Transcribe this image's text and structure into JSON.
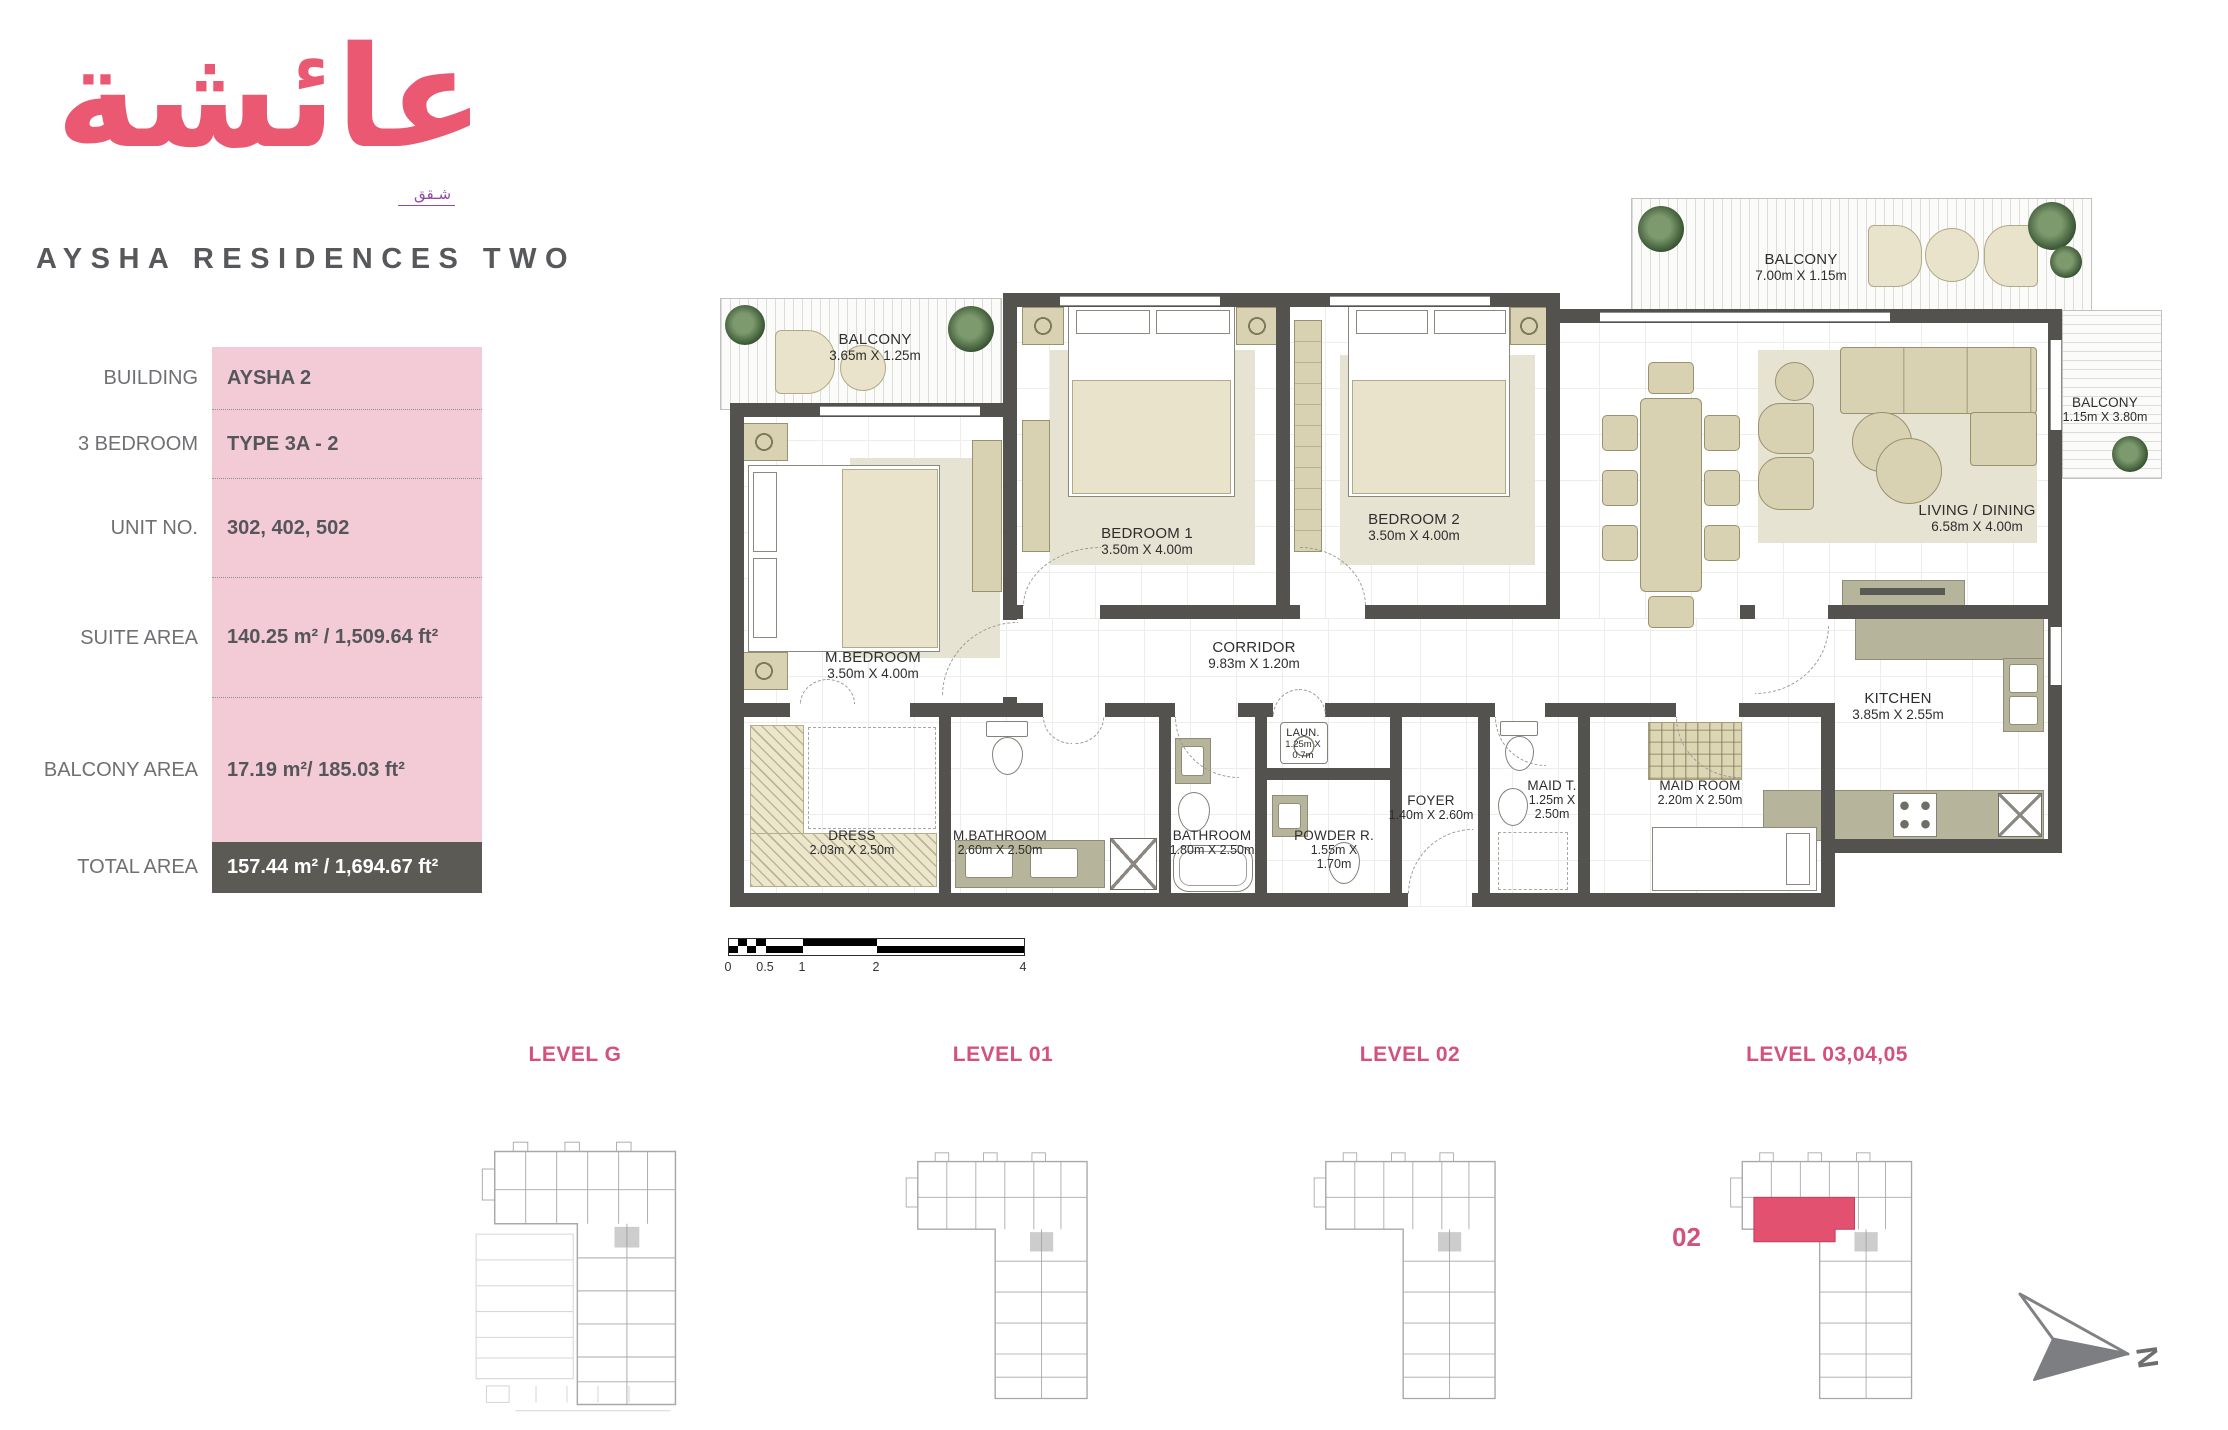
{
  "logo": {
    "arabic": "عائشة",
    "arabic_subtitle": "شـقق",
    "brand": "AYSHA RESIDENCES TWO"
  },
  "info_panel": {
    "rows": [
      {
        "label": "BUILDING",
        "value": "AYSHA 2"
      },
      {
        "label": "3 BEDROOM",
        "value": "TYPE 3A - 2"
      },
      {
        "label": "UNIT NO.",
        "value": "302, 402, 502"
      },
      {
        "label": "SUITE AREA",
        "value": "140.25 m² / 1,509.64 ft²"
      },
      {
        "label": "BALCONY AREA",
        "value": "17.19 m²/ 185.03 ft²"
      }
    ],
    "total_row": {
      "label": "TOTAL AREA",
      "value": "157.44 m² / 1,694.67 ft²"
    }
  },
  "floor_plan": {
    "rooms": {
      "balcony_tl": {
        "name": "BALCONY",
        "dims": "3.65m X 1.25m"
      },
      "balcony_top": {
        "name": "BALCONY",
        "dims": "7.00m X 1.15m"
      },
      "balcony_side": {
        "name": "BALCONY",
        "dims": "1.15m X 3.80m"
      },
      "m_bedroom": {
        "name": "M.BEDROOM",
        "dims": "3.50m X 4.00m"
      },
      "bedroom1": {
        "name": "BEDROOM 1",
        "dims": "3.50m X 4.00m"
      },
      "bedroom2": {
        "name": "BEDROOM 2",
        "dims": "3.50m X 4.00m"
      },
      "living": {
        "name": "LIVING / DINING",
        "dims": "6.58m X 4.00m"
      },
      "kitchen": {
        "name": "KITCHEN",
        "dims": "3.85m X 2.55m"
      },
      "corridor": {
        "name": "CORRIDOR",
        "dims": "9.83m X 1.20m"
      },
      "dress": {
        "name": "DRESS",
        "dims": "2.03m X 2.50m"
      },
      "m_bathroom": {
        "name": "M.BATHROOM",
        "dims": "2.60m X 2.50m"
      },
      "bathroom": {
        "name": "BATHROOM",
        "dims": "1.80m X 2.50m"
      },
      "powder": {
        "name": "POWDER R.",
        "dims": "1.55m X",
        "dims2": "1.70m"
      },
      "laundry": {
        "name": "LAUN.",
        "dims": "1.25m X",
        "dims2": "0.7m"
      },
      "foyer": {
        "name": "FOYER",
        "dims": "1.40m X 2.60m"
      },
      "maid_t": {
        "name": "MAID T.",
        "dims": "1.25m X",
        "dims2": "2.50m"
      },
      "maid_room": {
        "name": "MAID ROOM",
        "dims": "2.20m X 2.50m"
      }
    },
    "scale_bar": {
      "labels": [
        "0",
        "0.5",
        "1",
        "2",
        "4"
      ]
    }
  },
  "levels": [
    {
      "label": "LEVEL G"
    },
    {
      "label": "LEVEL 01"
    },
    {
      "label": "LEVEL 02"
    },
    {
      "label": "LEVEL 03,04,05",
      "highlighted_unit": "02"
    }
  ],
  "compass": {
    "north_label": "N"
  },
  "colors": {
    "accent_pink": "#ea5871",
    "level_pink": "#d2527b",
    "panel_pink": "#f3cbd7",
    "total_band": "#5b5a55",
    "wall": "#54524e",
    "furniture": "#d9d2b2",
    "counter": "#b7b49c",
    "highlight_unit_red": "#e2516f"
  }
}
